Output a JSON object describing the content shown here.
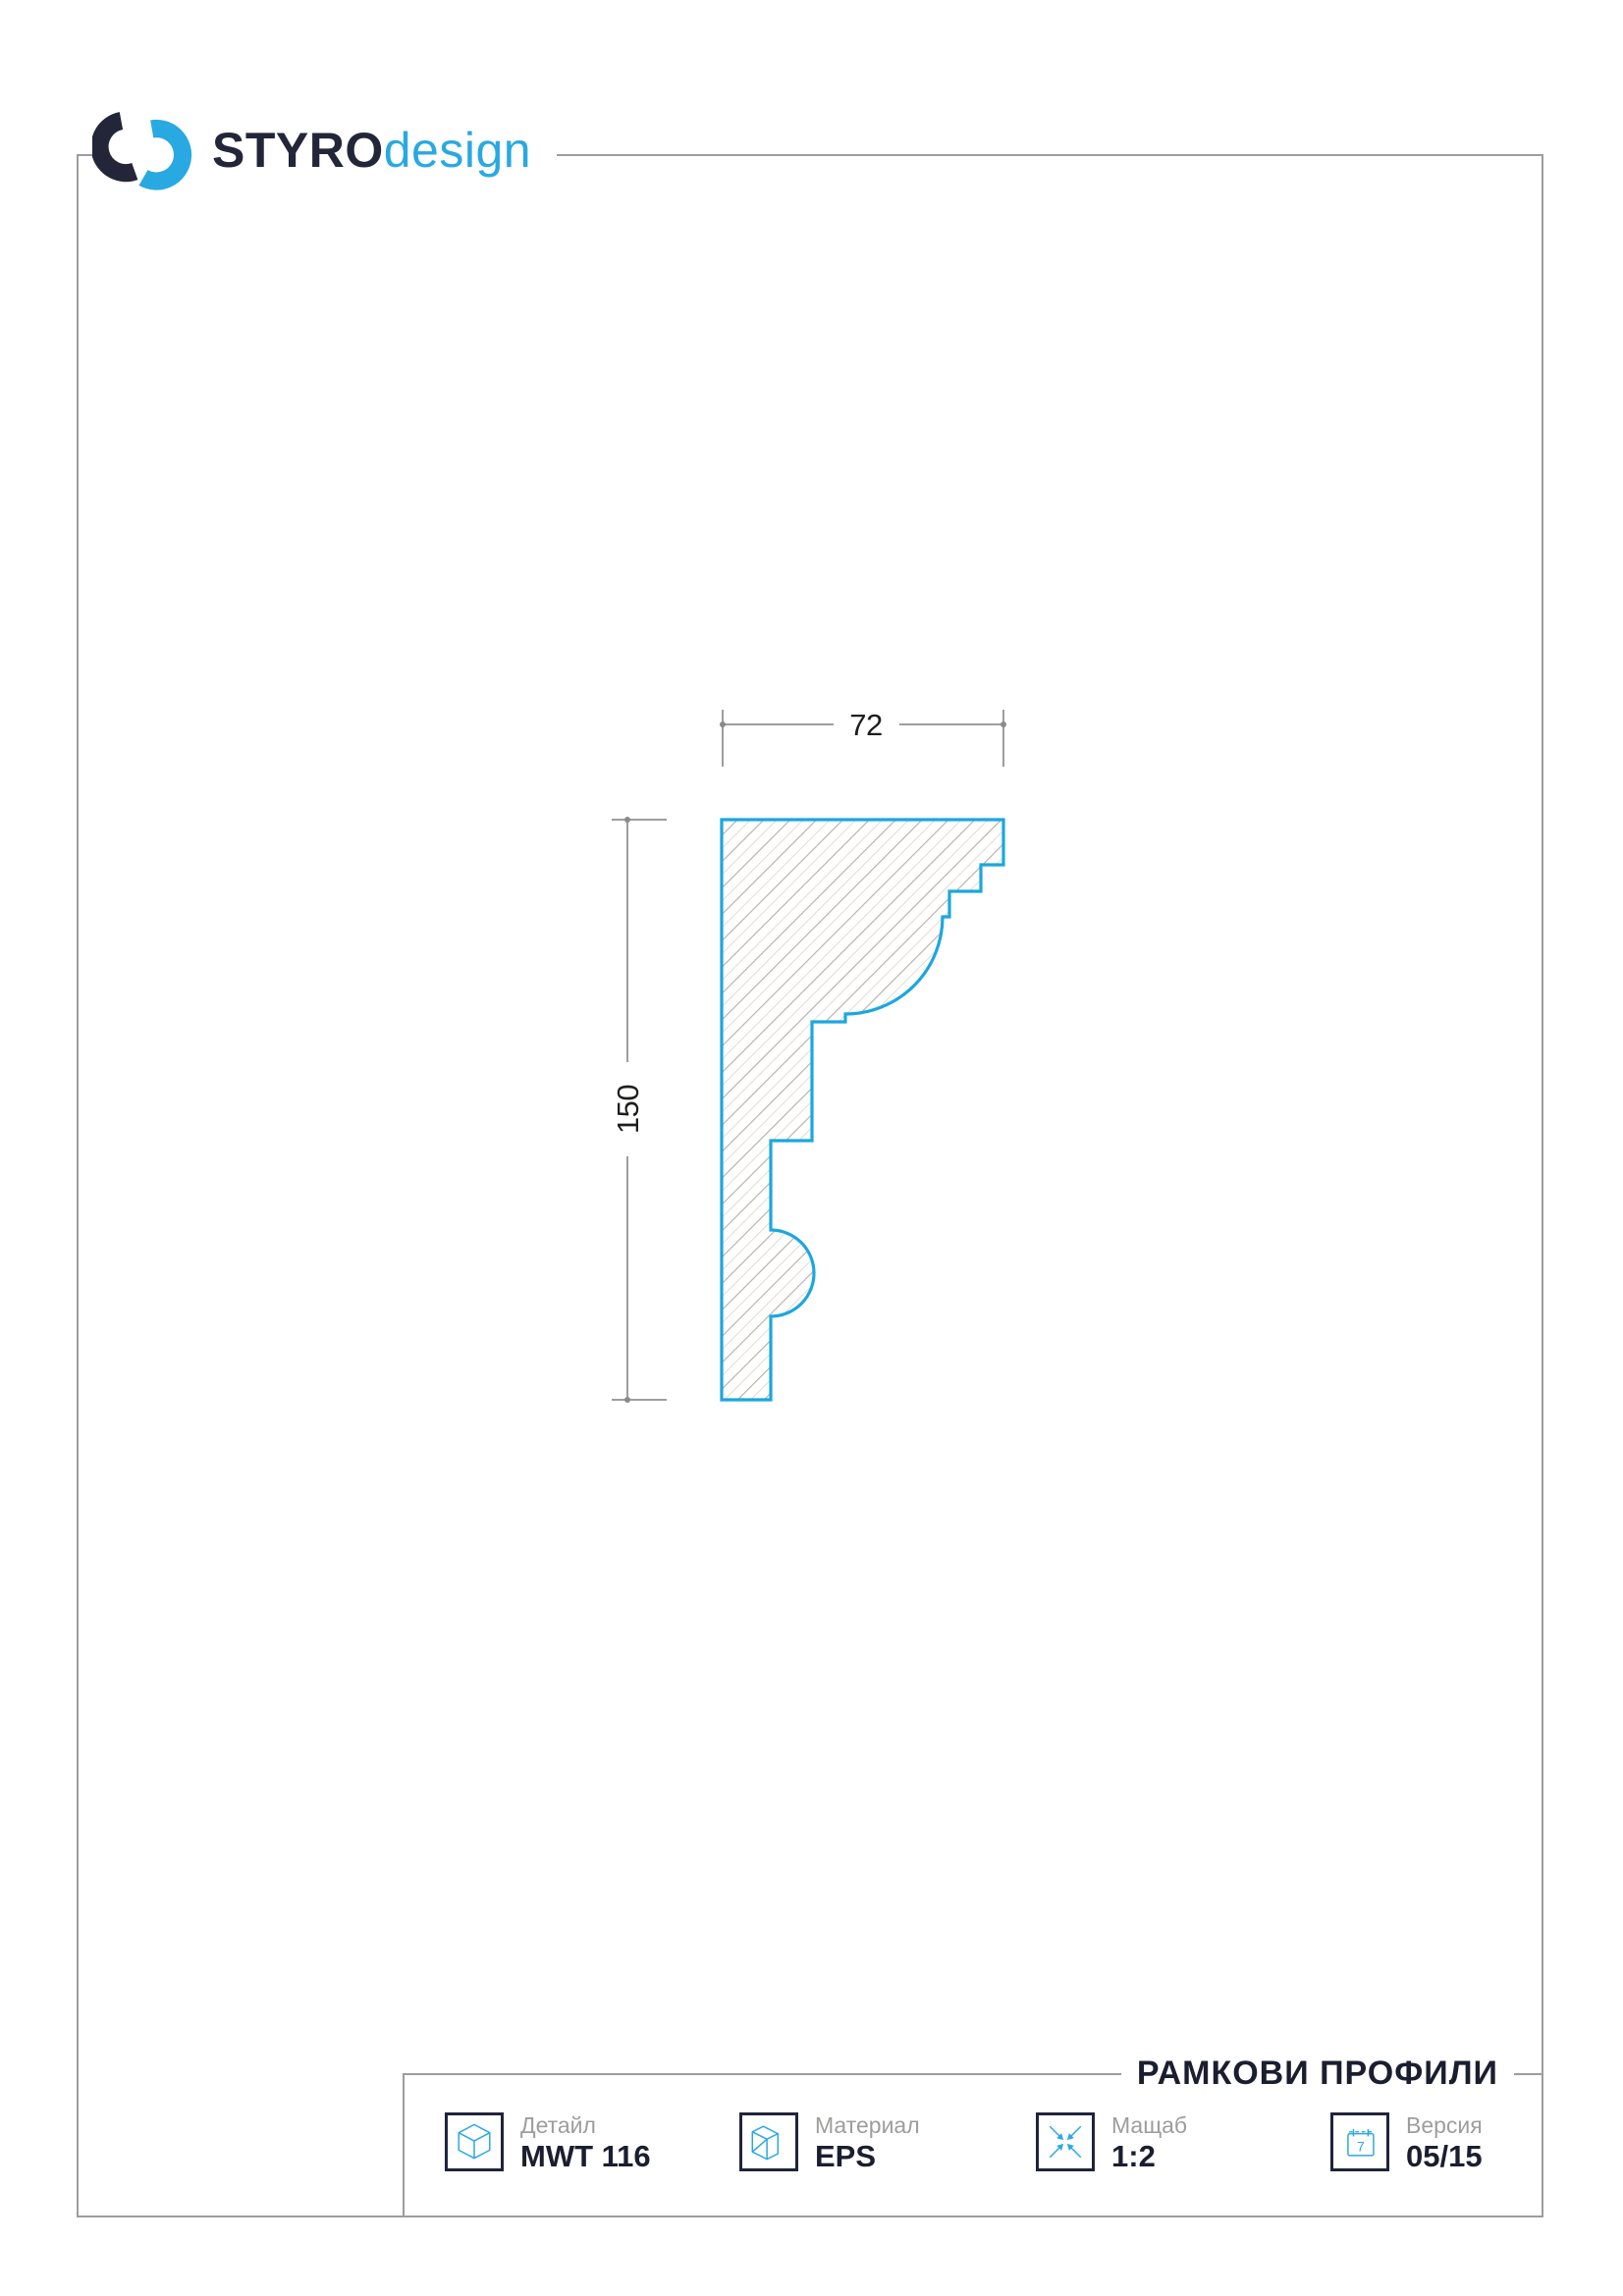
{
  "page": {
    "background": "#ffffff",
    "frame_color": "#9d9d9c"
  },
  "logo": {
    "brand_bold": "STYRO",
    "brand_light": "design",
    "mark_dark_color": "#232639",
    "mark_blue_color": "#29a9e1"
  },
  "drawing": {
    "type": "profile-cross-section",
    "width_label": "72",
    "height_label": "150",
    "outline_color": "#1ba7de",
    "hatch_color": "#b8afa7",
    "dim_line_color": "#9d9d9c",
    "dim_text_color": "#1d1d1b"
  },
  "footer": {
    "title": "РАМКОВИ ПРОФИЛИ",
    "items": [
      {
        "label": "Детайл",
        "value": "MWT 116",
        "icon": "cube-icon"
      },
      {
        "label": "Материал",
        "value": "EPS",
        "icon": "block-icon"
      },
      {
        "label": "Мащаб",
        "value": "1:2",
        "icon": "scale-icon"
      },
      {
        "label": "Версия",
        "value": "05/15",
        "icon": "calendar-icon"
      }
    ],
    "calendar_digit": "7",
    "accent_color": "#29a9e1",
    "title_color": "#1b1e2f"
  }
}
